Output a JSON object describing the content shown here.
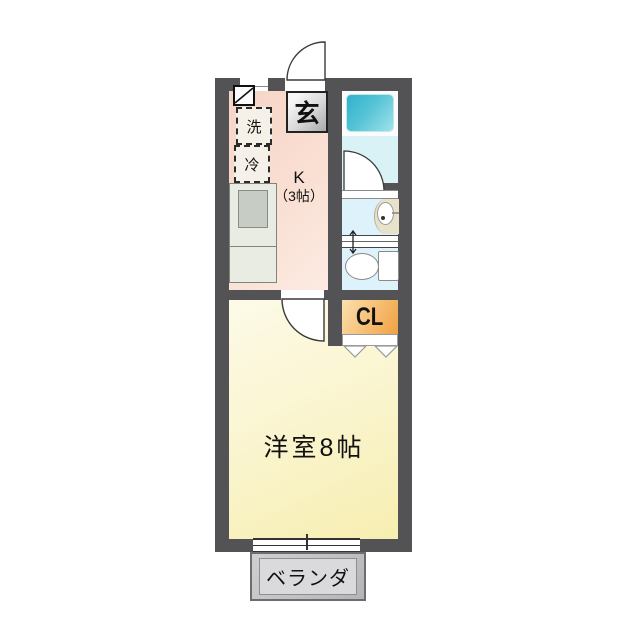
{
  "plan": {
    "rooms": {
      "entrance_label": "玄",
      "kitchen_label_line1": "K",
      "kitchen_label_line2": "（3帖）",
      "washer_label": "洗",
      "fridge_label": "冷",
      "closet_label": "CL",
      "main_room_label": "洋室8帖",
      "veranda_label": "ベランダ"
    },
    "colors": {
      "wall": "#535356",
      "kitchen_floor": "#f9ddd0",
      "main_room_floor": "#faf4cc",
      "bathroom_floor": "#d8f2f6",
      "sanitary_floor": "#def2fb",
      "bathtub": "#2fb2cb",
      "closet": "#efa142",
      "veranda": "#c2c2c4"
    }
  }
}
